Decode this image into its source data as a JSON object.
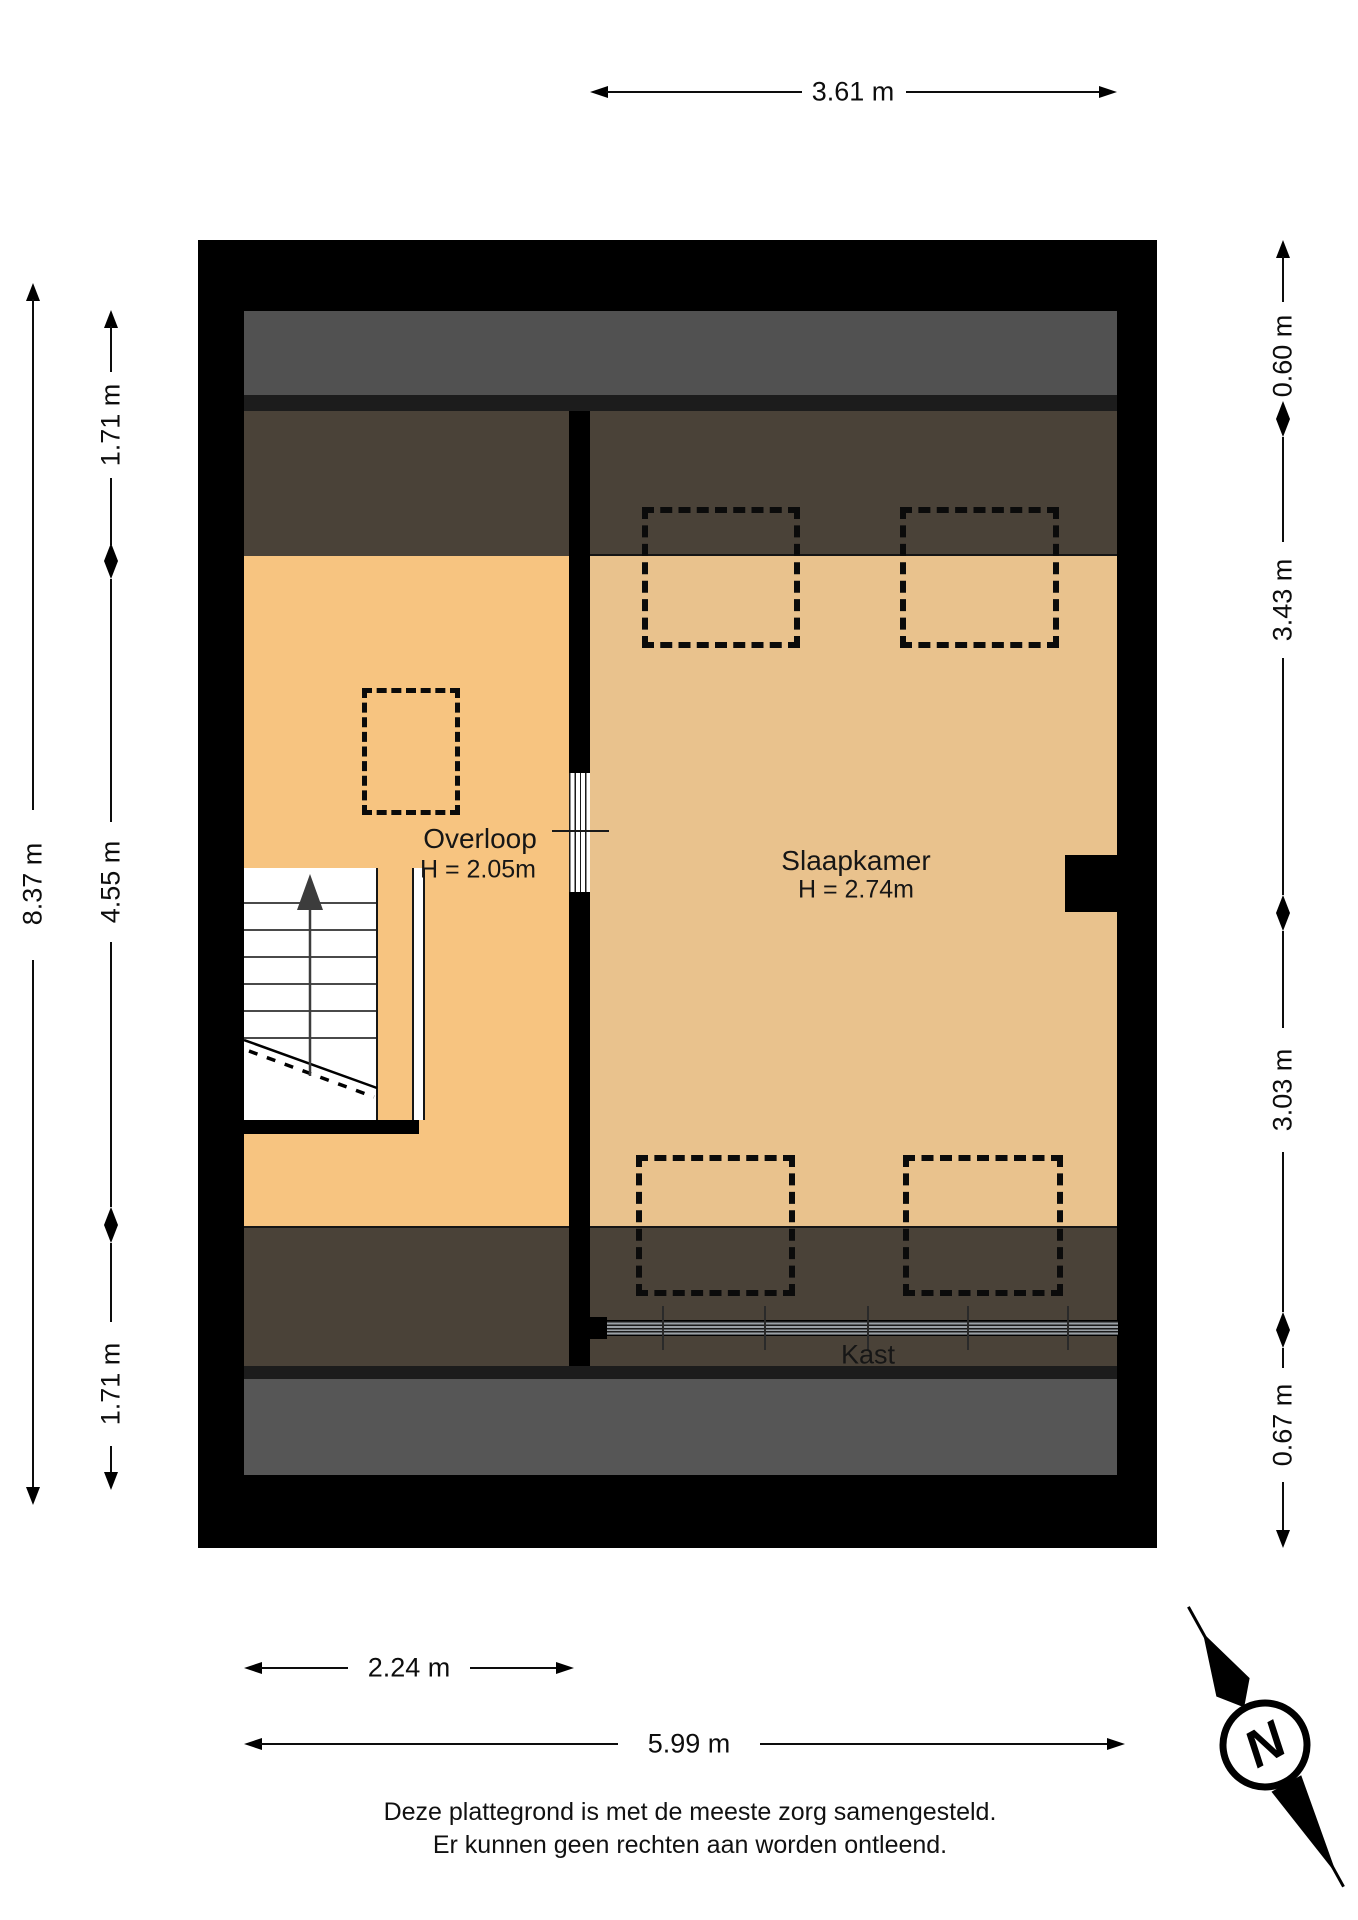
{
  "rooms": {
    "overloop": {
      "name": "Overloop",
      "height_label": "H = 2.05m"
    },
    "slaapkamer": {
      "name": "Slaapkamer",
      "height_label": "H = 2.74m"
    },
    "kast": {
      "name": "Kast"
    }
  },
  "dimensions": {
    "top_width": "3.61 m",
    "left_total": "8.37 m",
    "left_segments": [
      "1.71 m",
      "4.55 m",
      "1.71 m"
    ],
    "right_segments": [
      "0.60 m",
      "3.43 m",
      "3.03 m",
      "0.67 m"
    ],
    "bottom_overloop_width": "2.24 m",
    "bottom_total_width": "5.99 m"
  },
  "compass": {
    "north_label": "N"
  },
  "disclaimer": {
    "line1": "Deze plattegrond is met de meeste zorg samengesteld.",
    "line2": "Er kunnen geen rechten aan worden ontleend."
  },
  "colors": {
    "wall": "#000000",
    "roof_zone_grey_top": "#515151",
    "roof_zone_grey_bottom": "#565656",
    "divider_strip": "#1c1c1c",
    "sloped_ceiling_brown": "#4a4238",
    "overloop_floor": "#f7c480",
    "slaapkamer_floor": "#e9c28d"
  }
}
